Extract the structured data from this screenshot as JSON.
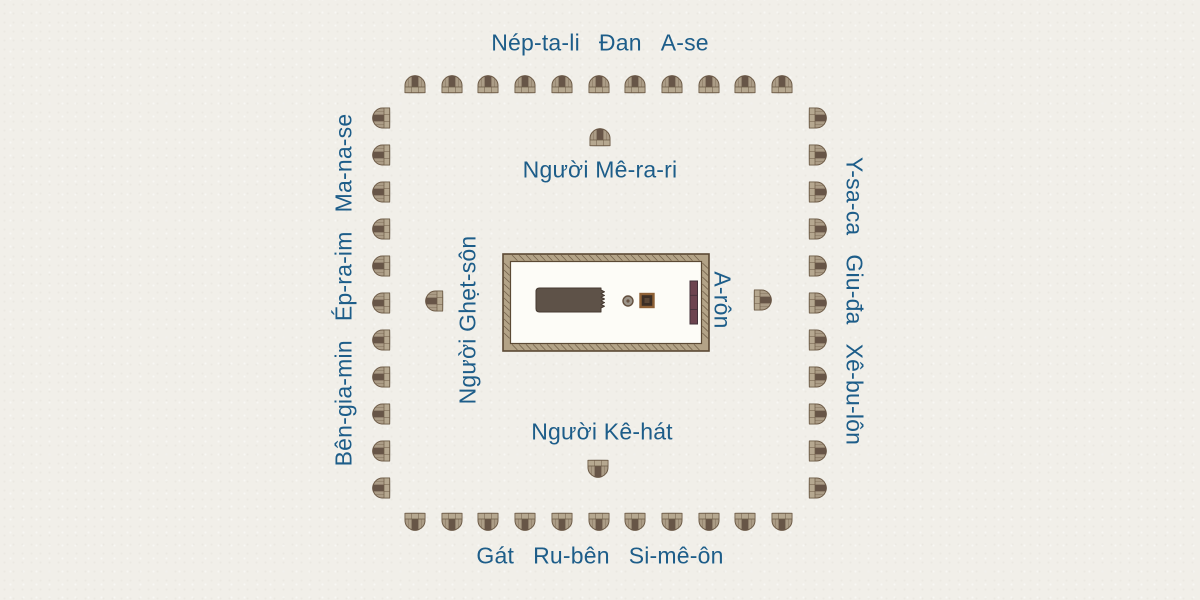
{
  "diagram": {
    "background_color": "#f1efe9",
    "label_color": "#1d5d89"
  },
  "camps": {
    "north": [
      "Nép-ta-li",
      "Đan",
      "A-se"
    ],
    "south": [
      "Gát",
      "Ru-bên",
      "Si-mê-ôn"
    ],
    "west": [
      "Bên-gia-min",
      "Ép-ra-im",
      "Ma-na-se"
    ],
    "east": [
      "Y-sa-ca",
      "Giu-đa",
      "Xê-bu-lôn"
    ]
  },
  "levites": {
    "north": "Người Mê-ra-ri",
    "south": "Người Kê-hát",
    "west": "Người Ghẹt-sôn",
    "east": "A-rôn"
  },
  "tents": {
    "per_side": 11,
    "body_color": "#ab9c86",
    "opening_color": "#675547",
    "band_color": "#b6a890",
    "outline_color": "#6e5c48"
  },
  "tabernacle": {
    "frame_color": "#b3a387",
    "frame_outline": "#5b4934",
    "courtyard_color": "#fdfcf7",
    "structure_color": "#5e5248",
    "laver_color": "#9d958a",
    "altar_border_color": "#8f6136",
    "altar_fill_color": "#3c2e25",
    "screen_color": "#6d4450"
  }
}
